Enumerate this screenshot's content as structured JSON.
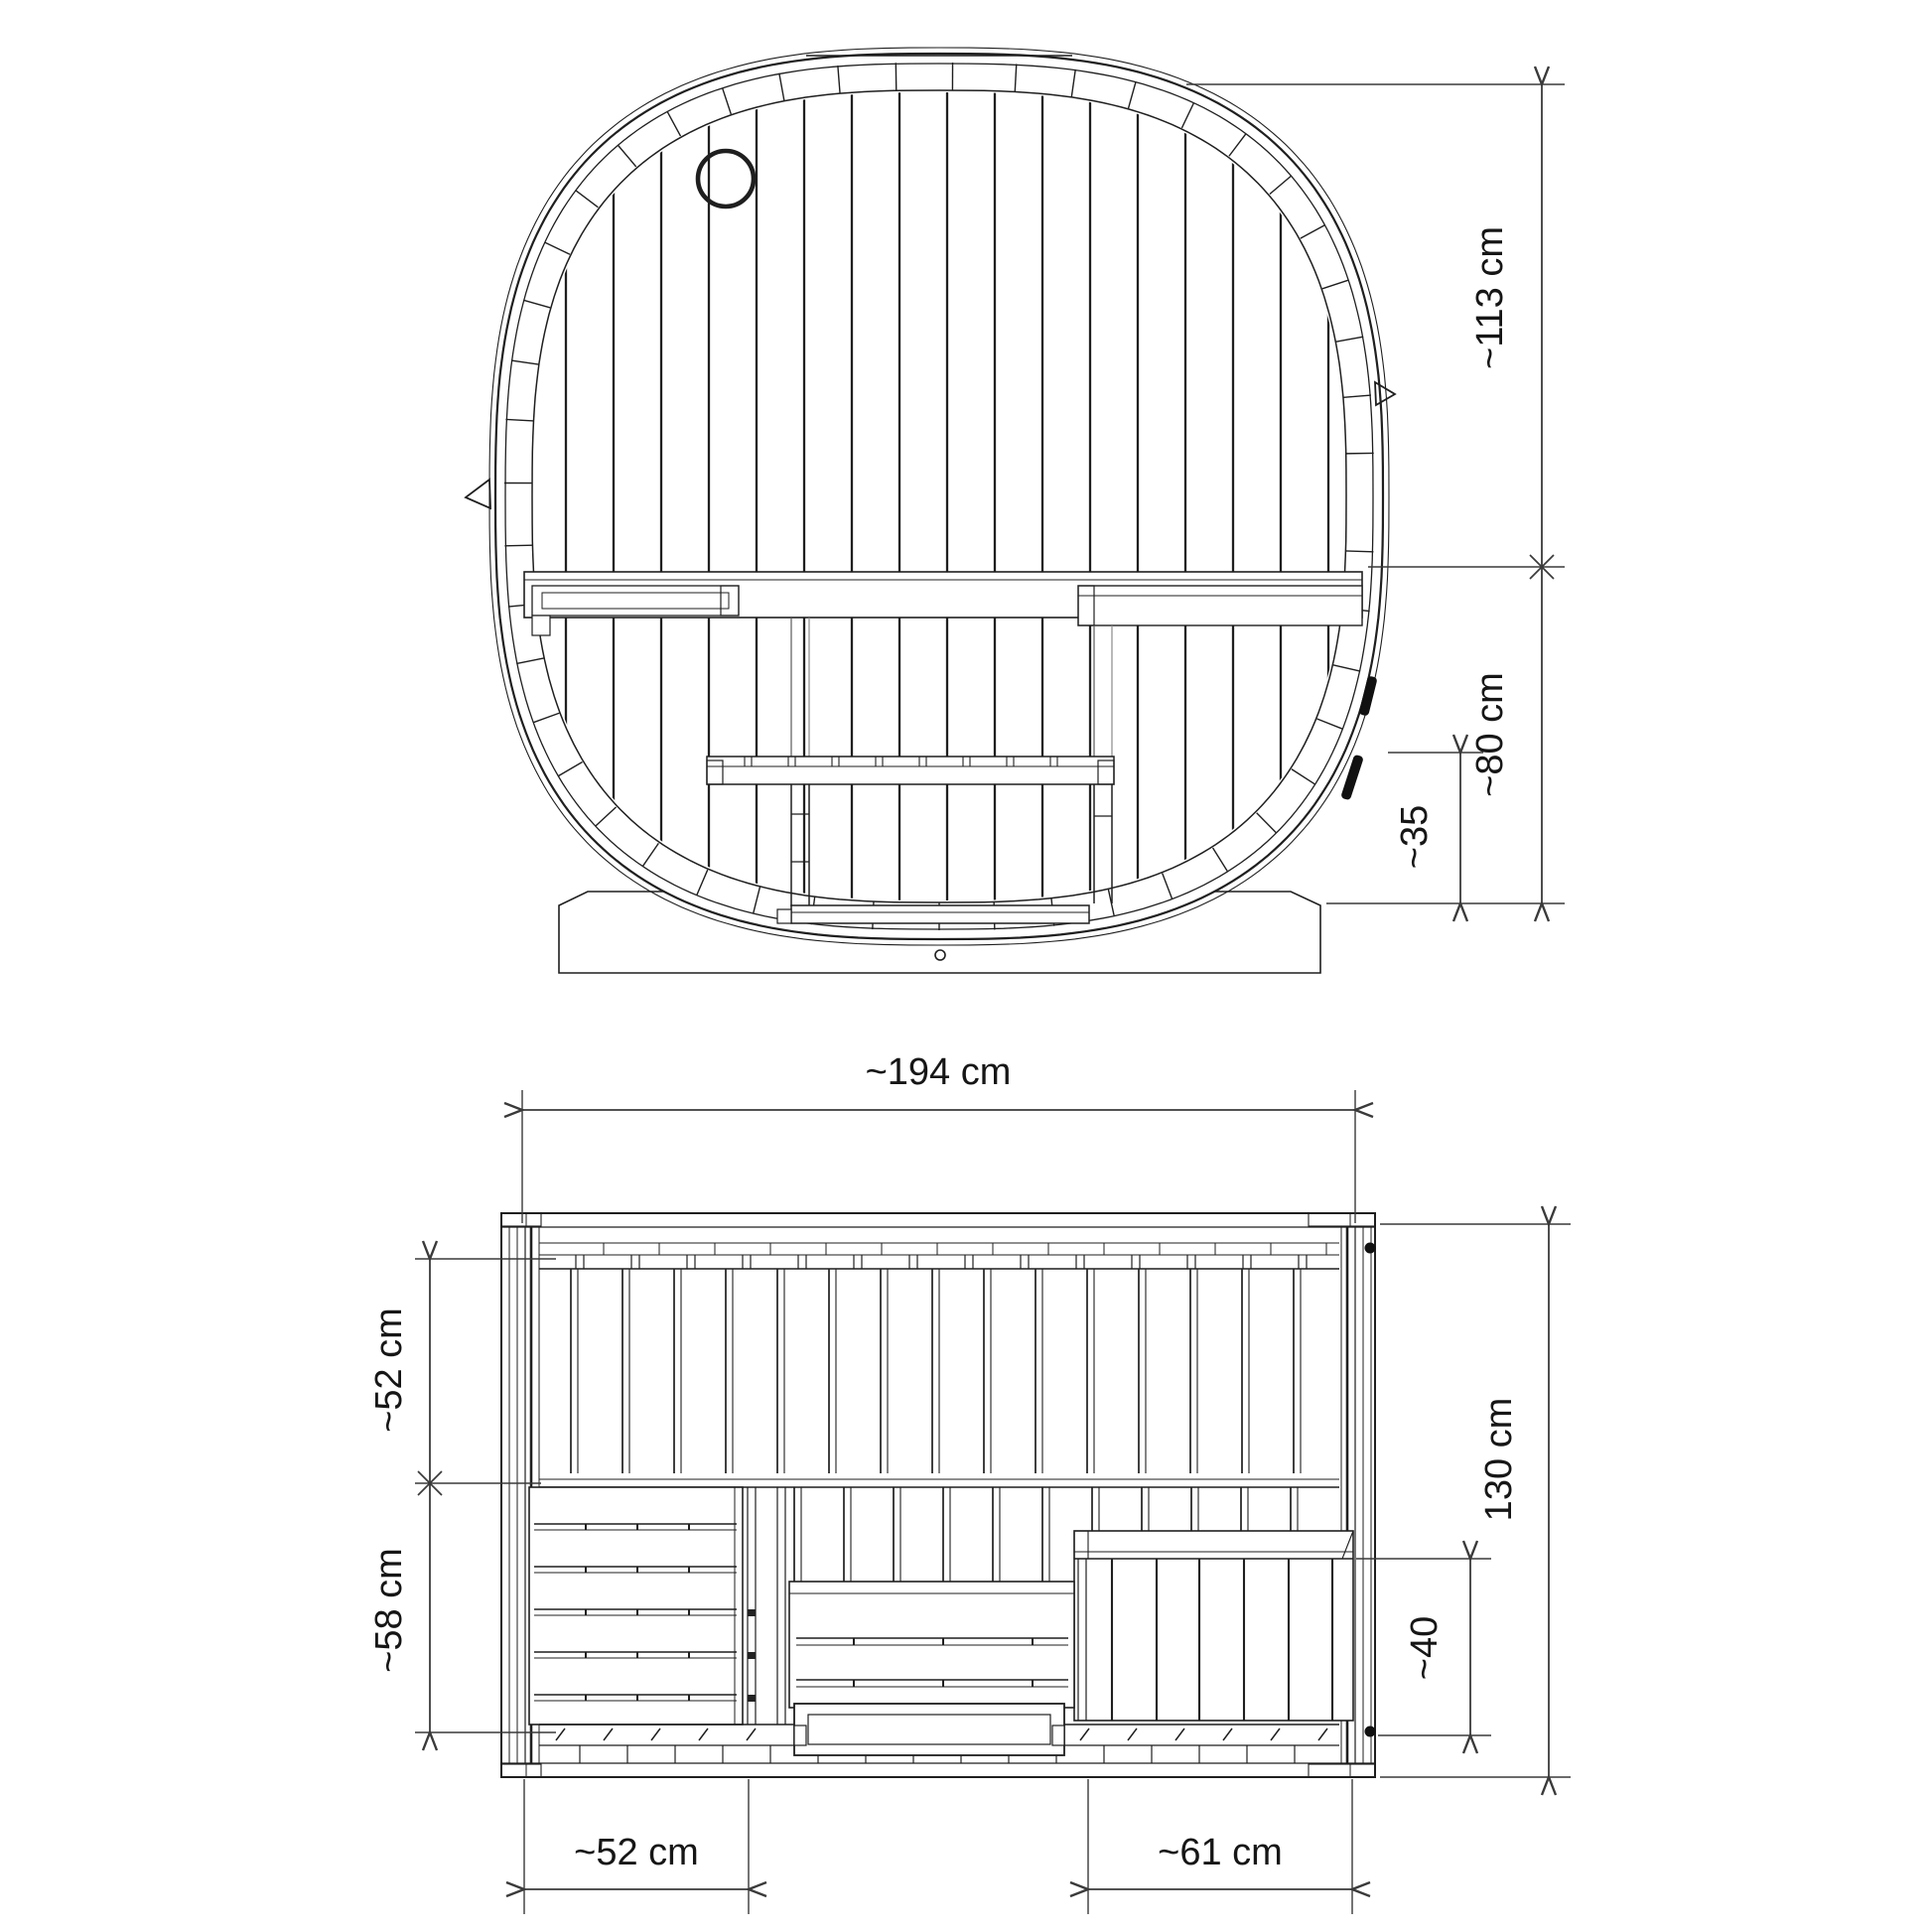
{
  "colors": {
    "line": "#1f1f1f",
    "dim": "#3a3a3a",
    "background": "#ffffff"
  },
  "front_view": {
    "dimensions": {
      "upper_height": {
        "label": "~113 cm"
      },
      "lower_height": {
        "label": "~80 cm"
      },
      "bench_height": {
        "label": "~35"
      }
    }
  },
  "plan_view": {
    "dimensions": {
      "overall_width": {
        "label": "~194 cm"
      },
      "back_bench_depth": {
        "label": "~52 cm"
      },
      "front_area_depth": {
        "label": "~58 cm"
      },
      "overall_depth": {
        "label": "130 cm"
      },
      "right_bench_depth": {
        "label": "~40"
      },
      "left_bench_width": {
        "label": "~52 cm"
      },
      "right_bench_width": {
        "label": "~61 cm"
      }
    }
  }
}
